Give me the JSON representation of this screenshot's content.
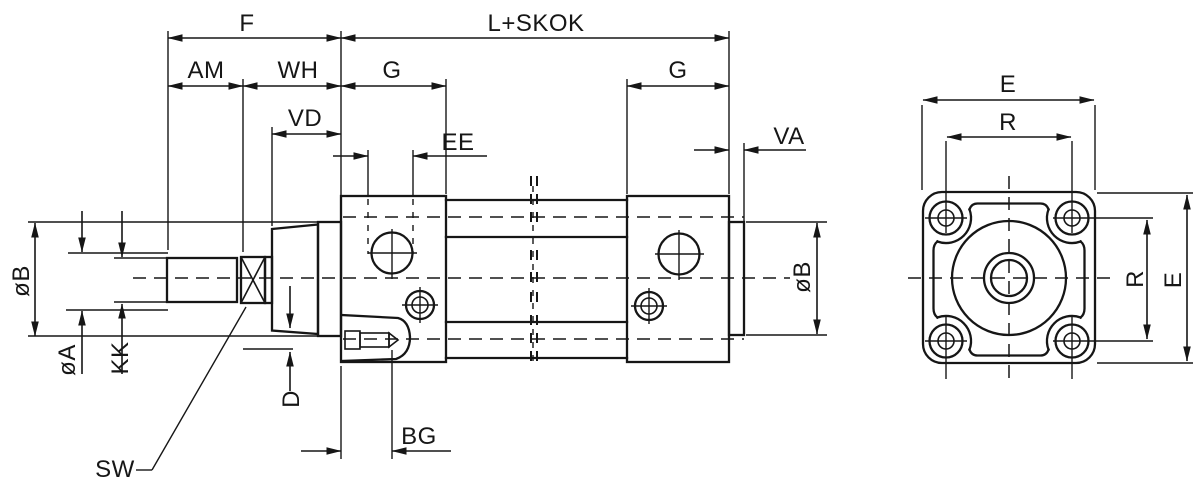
{
  "side_view": {
    "labels": {
      "f": "F",
      "l_plus_skok": "L+SKOK",
      "am": "AM",
      "wh": "WH",
      "vd": "VD",
      "g_front": "G",
      "g_rear": "G",
      "ee": "EE",
      "va": "VA",
      "dia_b_front": "øB",
      "dia_b_rear": "øB",
      "dia_a": "øA",
      "kk": "KK",
      "sw": "SW",
      "d": "D",
      "bg": "BG"
    }
  },
  "end_view": {
    "labels": {
      "e_top": "E",
      "r_top": "R",
      "r_side": "R",
      "e_side": "E"
    }
  },
  "style": {
    "line_color": "#161616",
    "background": "#ffffff"
  }
}
